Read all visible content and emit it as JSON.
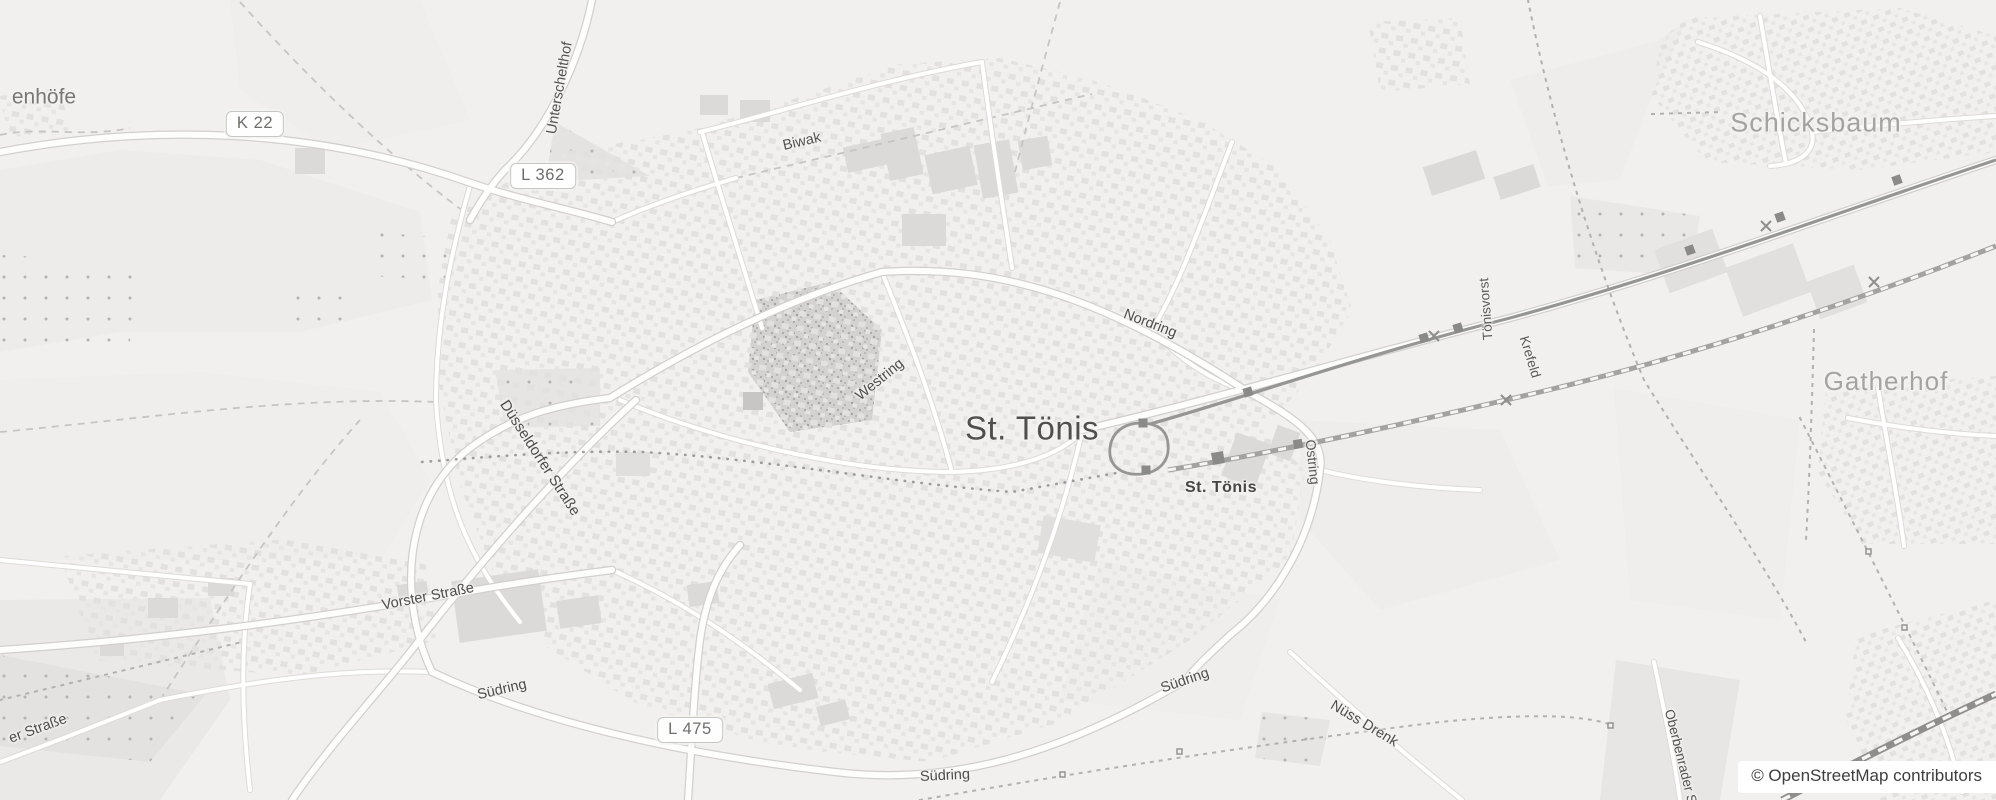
{
  "map": {
    "background": "#f1f0ee",
    "labels": [
      {
        "id": "place-label-enhoefe",
        "text": "enhöfe",
        "x": 44,
        "y": 97,
        "rot": 0,
        "size": 21,
        "color": "#777775",
        "weight": 400
      },
      {
        "id": "place-label-schicksbaum",
        "text": "Schicksbaum",
        "x": 1816,
        "y": 123,
        "rot": 0,
        "size": 27,
        "color": "#a3a3a1",
        "weight": 400,
        "spacing": 1
      },
      {
        "id": "place-label-st-toenis",
        "text": "St. Tönis",
        "x": 1032,
        "y": 428,
        "rot": 0,
        "size": 33,
        "color": "#4f4f4d",
        "weight": 400,
        "spacing": 0.5
      },
      {
        "id": "place-label-gatherhof",
        "text": "Gatherhof",
        "x": 1886,
        "y": 381,
        "rot": 0,
        "size": 26,
        "color": "#a3a3a1",
        "weight": 400,
        "spacing": 1
      },
      {
        "id": "station-label-st-toenis",
        "text": "St. Tönis",
        "x": 1221,
        "y": 488,
        "rot": 0,
        "size": 16,
        "color": "#454543",
        "weight": 700,
        "spacing": 0.5
      },
      {
        "id": "road-label-unterschelthof",
        "text": "Unterschelthof",
        "x": 560,
        "y": 88,
        "rot": -80,
        "size": 14.5,
        "color": "#535351",
        "weight": 400
      },
      {
        "id": "road-label-biwak",
        "text": "Biwak",
        "x": 802,
        "y": 142,
        "rot": -13,
        "size": 14.5,
        "color": "#535351",
        "weight": 400
      },
      {
        "id": "road-label-nordring",
        "text": "Nordring",
        "x": 1150,
        "y": 324,
        "rot": 21,
        "size": 14.5,
        "color": "#4c4c4a",
        "weight": 400
      },
      {
        "id": "road-label-westring",
        "text": "Westring",
        "x": 880,
        "y": 380,
        "rot": -39,
        "size": 14.5,
        "color": "#4c4c4a",
        "weight": 400
      },
      {
        "id": "road-label-ostring",
        "text": "Ostring",
        "x": 1313,
        "y": 462,
        "rot": 84,
        "size": 14,
        "color": "#5a5a58",
        "weight": 400
      },
      {
        "id": "road-label-toenisvorst",
        "text": "Tönisvorst",
        "x": 1486,
        "y": 309,
        "rot": -94,
        "size": 13.5,
        "color": "#5a5a58",
        "weight": 400
      },
      {
        "id": "road-label-krefeld",
        "text": "Krefeld",
        "x": 1530,
        "y": 357,
        "rot": 73,
        "size": 13.5,
        "color": "#5a5a58",
        "weight": 400
      },
      {
        "id": "road-label-duesseldorfer-strasse",
        "text": "Düsseldorfer Straße",
        "x": 540,
        "y": 458,
        "rot": 57,
        "size": 15,
        "color": "#4c4c4a",
        "weight": 400
      },
      {
        "id": "road-label-vorster-strasse",
        "text": "Vorster Straße",
        "x": 428,
        "y": 597,
        "rot": -11,
        "size": 14.5,
        "color": "#4c4c4a",
        "weight": 400
      },
      {
        "id": "road-label-suedring-west",
        "text": "Südring",
        "x": 502,
        "y": 690,
        "rot": -13,
        "size": 14.5,
        "color": "#4c4c4a",
        "weight": 400
      },
      {
        "id": "road-label-suedring-sued",
        "text": "Südring",
        "x": 945,
        "y": 776,
        "rot": -3,
        "size": 14.5,
        "color": "#4c4c4a",
        "weight": 400
      },
      {
        "id": "road-label-suedring-ost",
        "text": "Südring",
        "x": 1185,
        "y": 681,
        "rot": -19,
        "size": 14.5,
        "color": "#4c4c4a",
        "weight": 400
      },
      {
        "id": "road-label-er-strasse",
        "text": "er Straße",
        "x": 38,
        "y": 729,
        "rot": -20,
        "size": 14.5,
        "color": "#4c4c4a",
        "weight": 400
      },
      {
        "id": "road-label-nuess-drenk",
        "text": "Nüss Drenk",
        "x": 1364,
        "y": 724,
        "rot": 31,
        "size": 14.5,
        "color": "#4c4c4a",
        "weight": 400
      },
      {
        "id": "road-label-oberbenrader",
        "text": "Oberbenrader Str.",
        "x": 1682,
        "y": 762,
        "rot": 76,
        "size": 13.5,
        "color": "#535351",
        "weight": 400
      }
    ],
    "shields": [
      {
        "id": "road-shield-k22",
        "text": "K 22",
        "x": 255,
        "y": 124
      },
      {
        "id": "road-shield-l362",
        "text": "L 362",
        "x": 543,
        "y": 176
      },
      {
        "id": "road-shield-l475",
        "text": "L 475",
        "x": 690,
        "y": 730
      }
    ],
    "attribution": {
      "text": "© OpenStreetMap contributors",
      "bg": "#ffffff",
      "color": "#3e3e3e"
    }
  }
}
